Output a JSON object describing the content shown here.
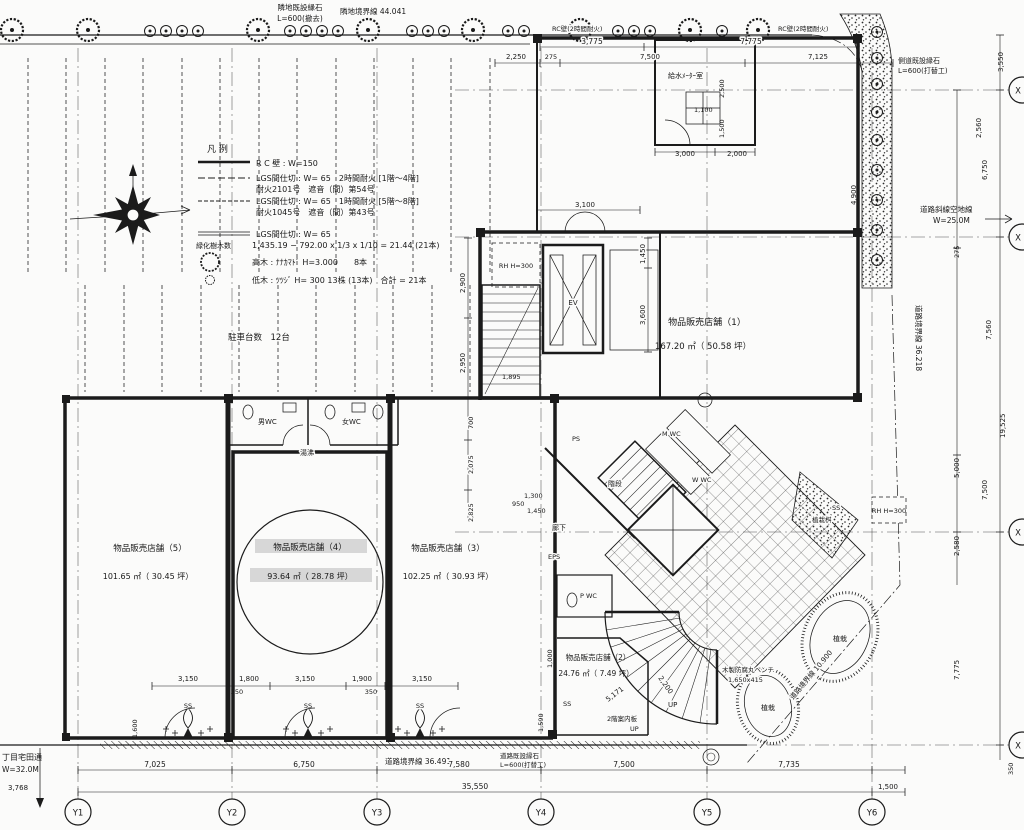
{
  "colors": {
    "ink": "#1b1b1b",
    "paper": "#fbfbfa",
    "highlight": "#b9b9b9"
  },
  "boundary": {
    "north_curb1": "隣地既設縁石",
    "north_curb2": "L=600(撤去)",
    "north_line": "隣地境界線 44.041",
    "east_curb1": "側道既設縁石",
    "east_curb2": "L=600(打替工)",
    "east_setback1": "道路斜線空地線",
    "east_setback2": "W=25.0M",
    "east_line": "道路境界線 36.218",
    "south_line": "道路境界線 36.491",
    "south_curb1": "道路既設縁石",
    "south_curb2": "L=600(打替工)",
    "southeast_line": "道路境界線 10.900",
    "road_name": "丁目宅田通",
    "road_width": "W=32.0M"
  },
  "legend": {
    "title": "凡 例",
    "rc_wall": "R C 壁 : W=150",
    "lgs1a": "LGS間仕切 : W= 65　2時間耐火 [1階〜4階]",
    "lgs1b": "耐火2101号　遮音（間）第54号",
    "lgs2a": "LGS間仕切 : W= 65　1時間耐火 [5階〜8階]",
    "lgs2b": "耐火1045号　遮音（間）第43号",
    "lgs3": "LGS間仕切 : W= 65",
    "green_label": "緑化樹木数",
    "green_calc": "1,435.19 − 792.00 x 1/3 x 1/10 = 21.44 (21本)",
    "tall_tree": "高木 : ﾅﾅｶﾏﾄﾞ H=3.000　　8本",
    "low_tree": "低木 : ﾂﾂｼﾞ H= 300 13株 (13本)　合計 = 21本"
  },
  "parking": {
    "label": "駐車台数　12台"
  },
  "rooms": {
    "store1_name": "物品販売店舗（1）",
    "store1_area": "167.20 ㎡（ 50.58 坪）",
    "store2_name": "物品販売店舗（2）",
    "store2_area": "24.76 ㎡（ 7.49 坪）",
    "store3_name": "物品販売店舗（3）",
    "store3_area": "102.25 ㎡（ 30.93 坪）",
    "store4_name": "物品販売店舗（4）",
    "store4_area": "93.64 ㎡（ 28.78 坪）",
    "store5_name": "物品販売店舗（5）",
    "store5_area": "101.65 ㎡（ 30.45 坪）",
    "meter_room": "給水ﾒｰﾀｰ室",
    "wc_men": "男WC",
    "wc_women": "女WC",
    "hot_water": "湯沸",
    "wc_m": "M WC",
    "wc_w": "W WC",
    "wc_p": "P WC",
    "stair": "階段",
    "corridor": "廊下",
    "ps": "PS",
    "eps": "EPS",
    "ev": "EV",
    "rh1": "RH H=300",
    "rh2": "RH H=300",
    "wall_fire_l": "RC壁(2時間耐火)",
    "wall_fire_r": "RC壁(2時間耐火)",
    "up1": "UP",
    "up2": "UP",
    "sign_2f": "2階案内板"
  },
  "plaza": {
    "planter1": "植栽",
    "planter2": "植栽",
    "planter3": "植栽桝",
    "bench1": "木製防腐丸ベンチ",
    "bench2": "1,650x415",
    "ss": [
      "SS",
      "SS",
      "SS",
      "SS",
      "SS"
    ]
  },
  "grid": {
    "y": [
      "Y1",
      "Y2",
      "Y3",
      "Y4",
      "Y5",
      "Y6"
    ],
    "x": [
      "X",
      "X",
      "X",
      "X"
    ]
  },
  "dims": {
    "top": [
      "3,775",
      "7,775",
      "2,250",
      "275",
      "7,500",
      "7,125",
      "3,000",
      "2,000",
      "2,500",
      "1,500",
      "1,100",
      "3,100"
    ],
    "right": [
      "3,550",
      "2,560",
      "6,750",
      "275",
      "7,560",
      "19,525",
      "5,000",
      "7,500",
      "2,580",
      "7,775",
      "350",
      "4,900"
    ],
    "bottom": [
      "7,025",
      "6,750",
      "7,580",
      "7,500",
      "7,735",
      "35,550",
      "1,500",
      "3,768"
    ],
    "left": [
      "2,900",
      "2,950",
      "700",
      "2,075",
      "2,825",
      "1,895",
      "1,300",
      "1,450",
      "1,450",
      "3,600",
      "950",
      "1,590"
    ],
    "front": [
      "3,150",
      "1,800",
      "3,150",
      "1,900",
      "3,150",
      "350",
      "350",
      "1,600",
      "5,171",
      "2,200",
      "1,000"
    ]
  }
}
